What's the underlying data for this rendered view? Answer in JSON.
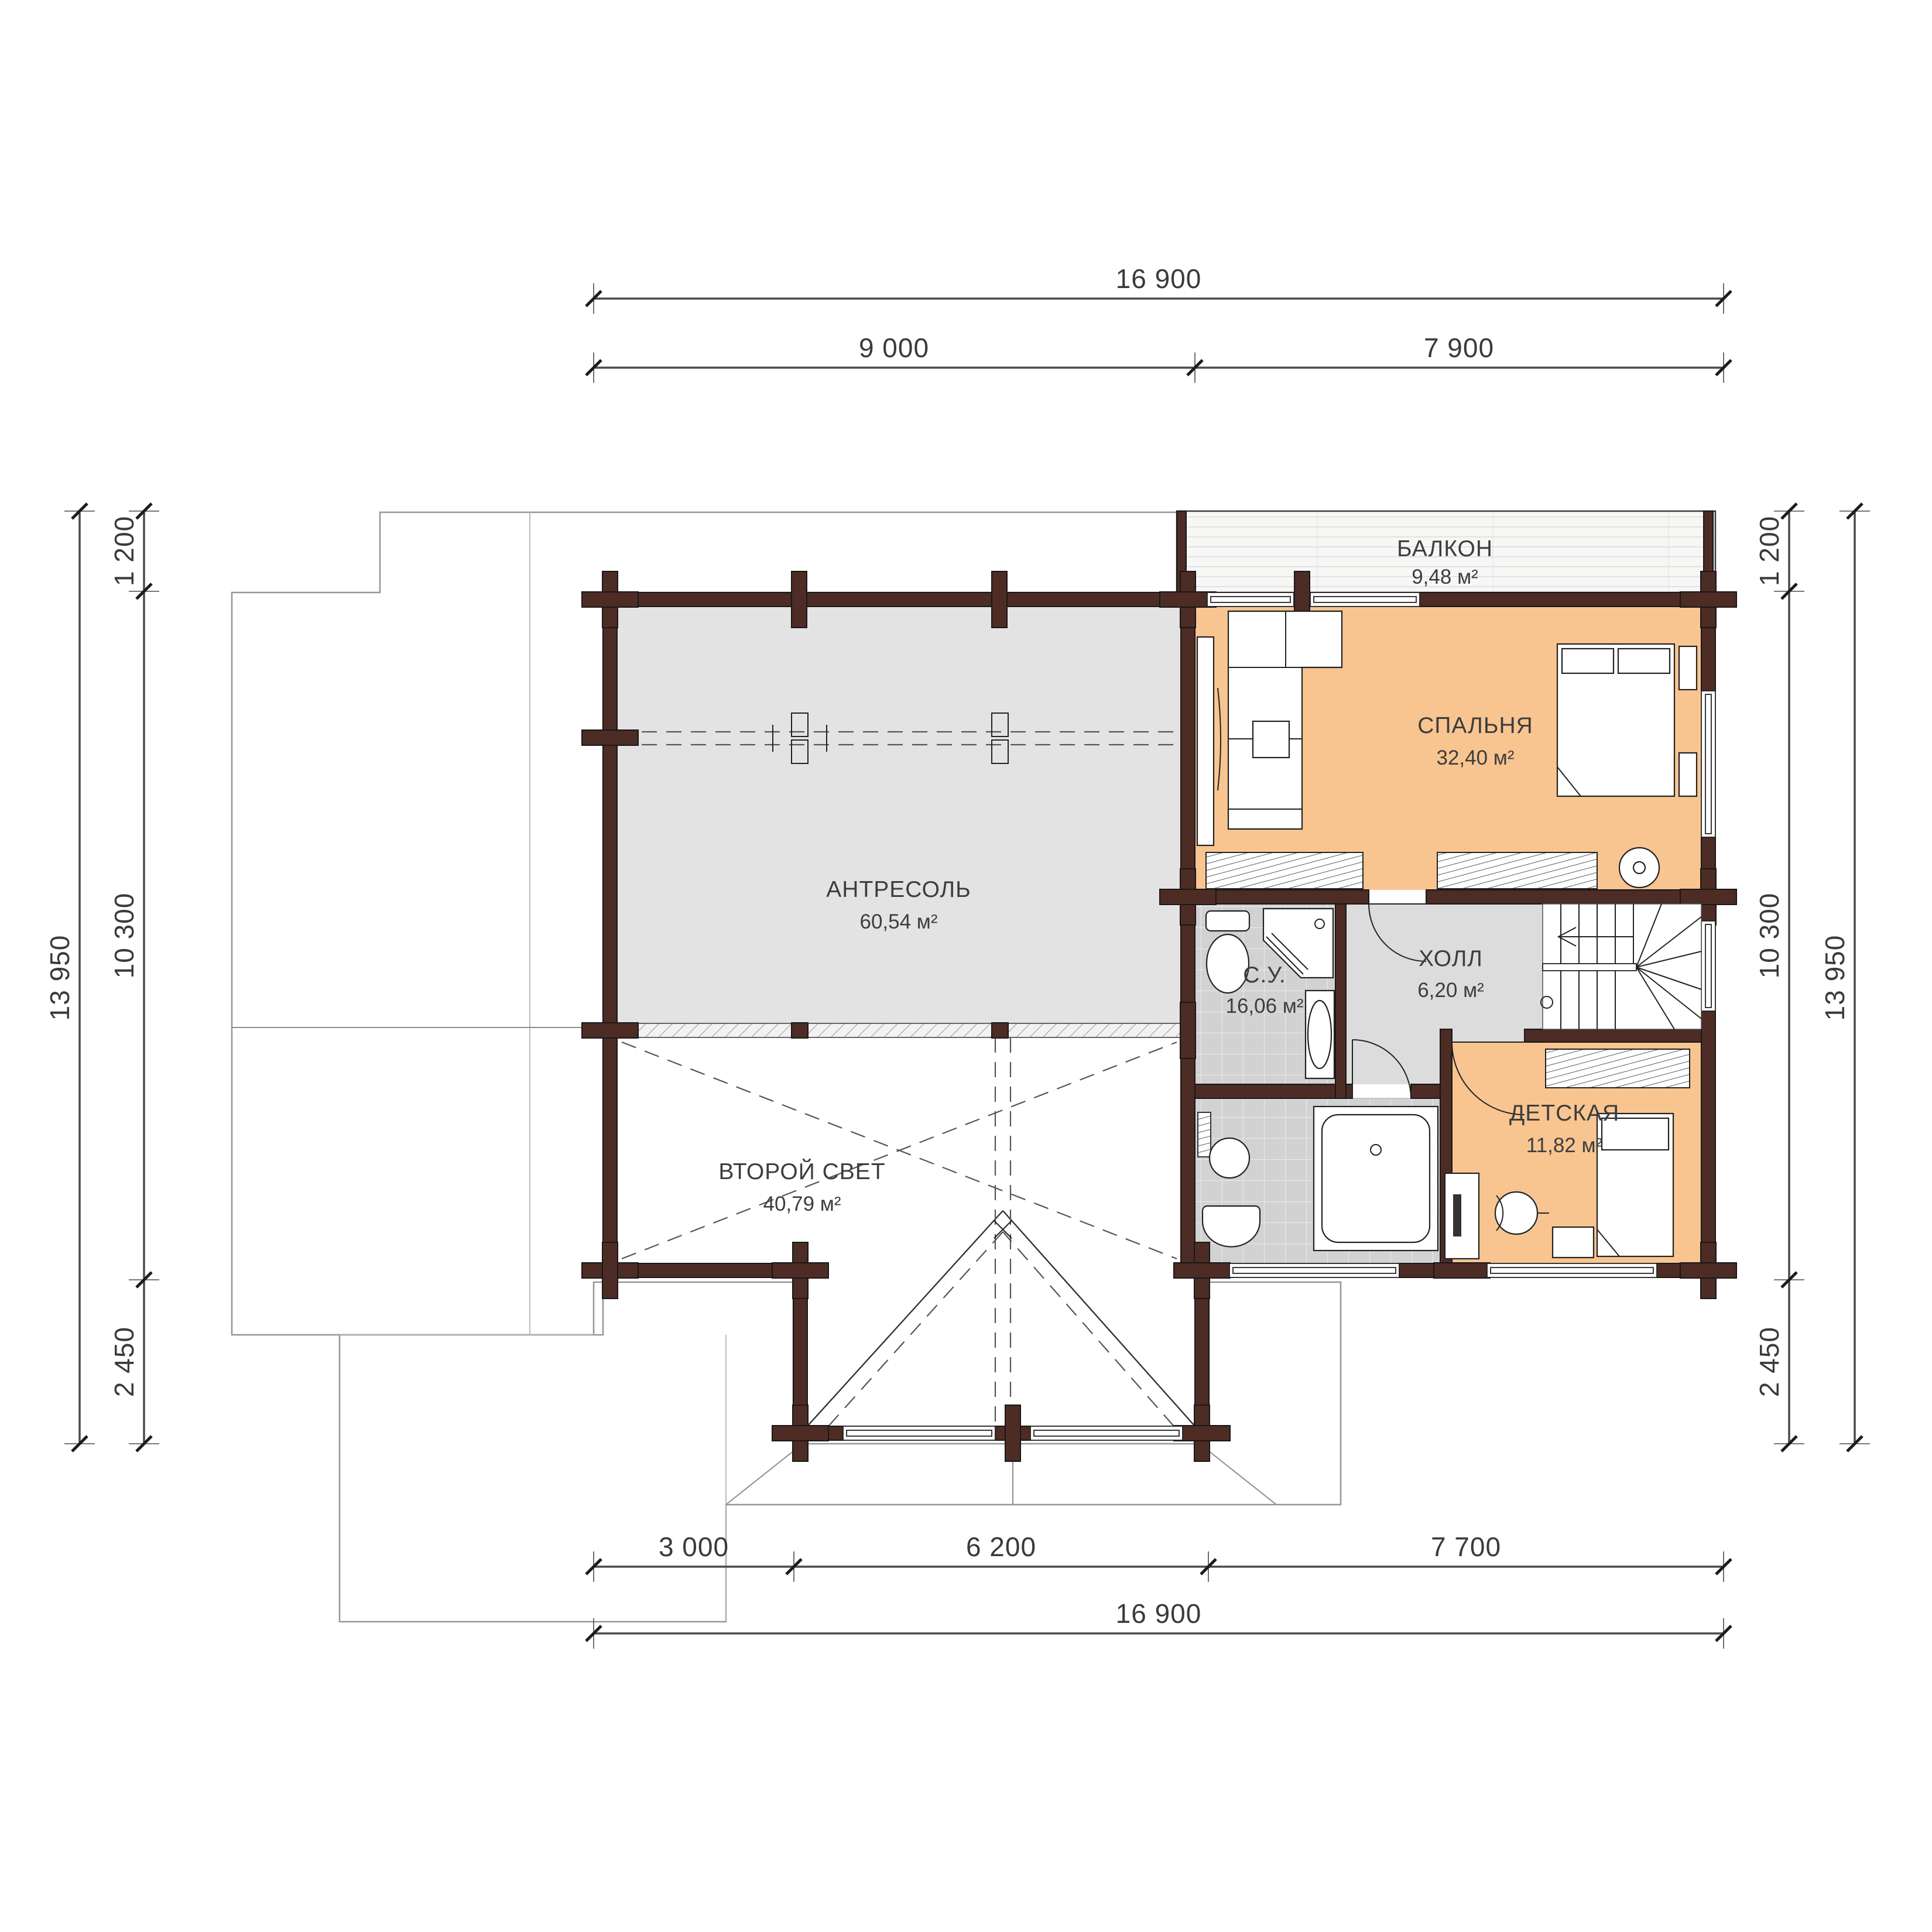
{
  "plan": {
    "title": "floor-plan-second-level",
    "rooms": [
      {
        "id": "balcony",
        "name": "БАЛКОН",
        "area": "9,48 м²"
      },
      {
        "id": "bedroom",
        "name": "СПАЛЬНЯ",
        "area": "32,40 м²"
      },
      {
        "id": "mezzanine",
        "name": "АНТРЕСОЛЬ",
        "area": "60,54 м²"
      },
      {
        "id": "bathroom",
        "name": "С.У.",
        "area": "16,06 м²"
      },
      {
        "id": "hall",
        "name": "ХОЛЛ",
        "area": "6,20 м²"
      },
      {
        "id": "kids_room",
        "name": "ДЕТСКАЯ",
        "area": "11,82 м²"
      },
      {
        "id": "void",
        "name": "ВТОРОЙ СВЕТ",
        "area": "40,79 м²"
      }
    ],
    "dimensions": {
      "top_total": "16 900",
      "top_left": "9 000",
      "top_right": "7 900",
      "bottom_1": "3 000",
      "bottom_2": "6 200",
      "bottom_3": "7 700",
      "bottom_total": "16 900",
      "left_total": "13 950",
      "left_1": "1 200",
      "left_2": "10 300",
      "left_3": "2 450",
      "right_1": "1 200",
      "right_2": "10 300",
      "right_3": "2 450",
      "right_total": "13 950"
    },
    "colors": {
      "walls": "#4d2c26",
      "room_warm": "#f8c591",
      "mezzanine": "#e3e3e3",
      "hall": "#dcdcdc",
      "tile": "#d2d2d2",
      "void": "#ffffff",
      "roof": "#fcfcfc",
      "dim_text": "#3a3a3a"
    }
  }
}
